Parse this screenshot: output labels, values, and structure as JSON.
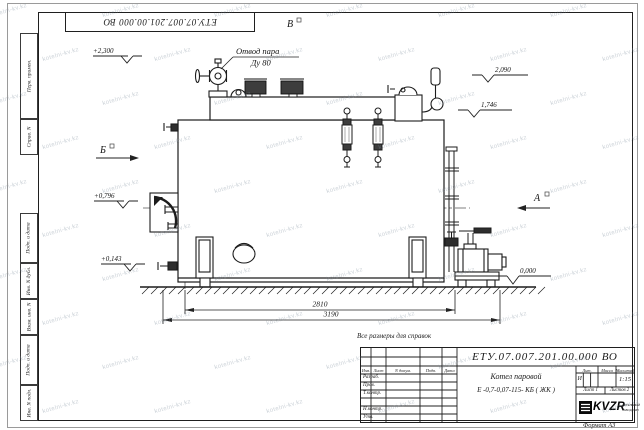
{
  "sheet": {
    "doc_number_top": "ЕТУ.07.007.201.00.000  ВО",
    "reference_note": "Все размеры для справок",
    "format_note": "Формат А3"
  },
  "title_block": {
    "doc_number": "ЕТУ.07.007.201.00.000  ВО",
    "name_line1": "Котел паровой",
    "name_line2": "Е -0,7-0,07-115- КБ ( ЖК )",
    "col_izm": "Изм.",
    "col_list": "Лист",
    "col_docnum": "N докум.",
    "col_podp": "Подп.",
    "col_data": "Дата",
    "row_razrab": "Разраб.",
    "row_prov": "Пров.",
    "row_tkontr": "Т.контр.",
    "row_nkontr": "Н.контр.",
    "row_utv": "Утв.",
    "lit_header": "Лит.",
    "mass_header": "Масса",
    "scale_header": "Масштаб",
    "lit_value": "И",
    "scale_value": "1:15",
    "sheet_info": "Лист 1",
    "sheets_info": "Листов 2",
    "logo_text": "KVZR",
    "logo_caption1": "КОТЕЛЬНЫЙ",
    "logo_caption2": "ЗАВОД РЭП"
  },
  "margin_stamps": {
    "perv_primen": "Перв. примен.",
    "sprav_n": "Справ. N",
    "podp_data_1": "Подп. и дата",
    "inv_dubl": "Инв. N дубл.",
    "vzam_inv": "Взам. инв. N",
    "podp_data_2": "Подп. и дата",
    "inv_podl": "Инв. N подл."
  },
  "drawing": {
    "callout_steam_line1": "Отвод пара",
    "callout_steam_line2": "Ду 80",
    "view_label_a": "А",
    "view_label_b": "Б",
    "view_label_v": "В",
    "elev_top": "+2,300",
    "elev_door": "+0,796",
    "elev_low": "+0,143",
    "elev_right_top": "2,090",
    "elev_right_mid": "1,746",
    "elev_ground": "0,000",
    "dim_inner": "2810",
    "dim_outer": "3190"
  },
  "watermark": {
    "text": "kotelni-kv.kz"
  }
}
